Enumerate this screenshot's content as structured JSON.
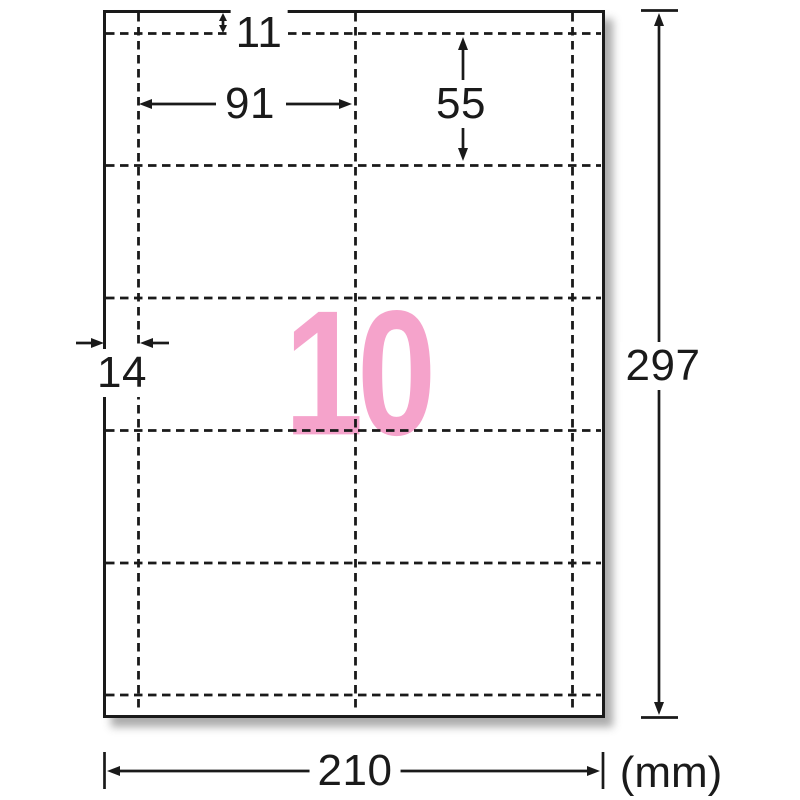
{
  "figure": {
    "count_label": "10",
    "unit_label": "(mm)",
    "dimensions": {
      "top_margin_mm": "11",
      "card_width_mm": "91",
      "card_height_mm": "55",
      "side_margin_mm": "14",
      "sheet_height_mm": "297",
      "sheet_width_mm": "210"
    },
    "grid": {
      "columns": 2,
      "rows": 5,
      "cells": 10
    },
    "colors": {
      "line": "#1a1a1a",
      "count_pink": "#f5a3cb",
      "sheet_bg": "#ffffff"
    }
  }
}
